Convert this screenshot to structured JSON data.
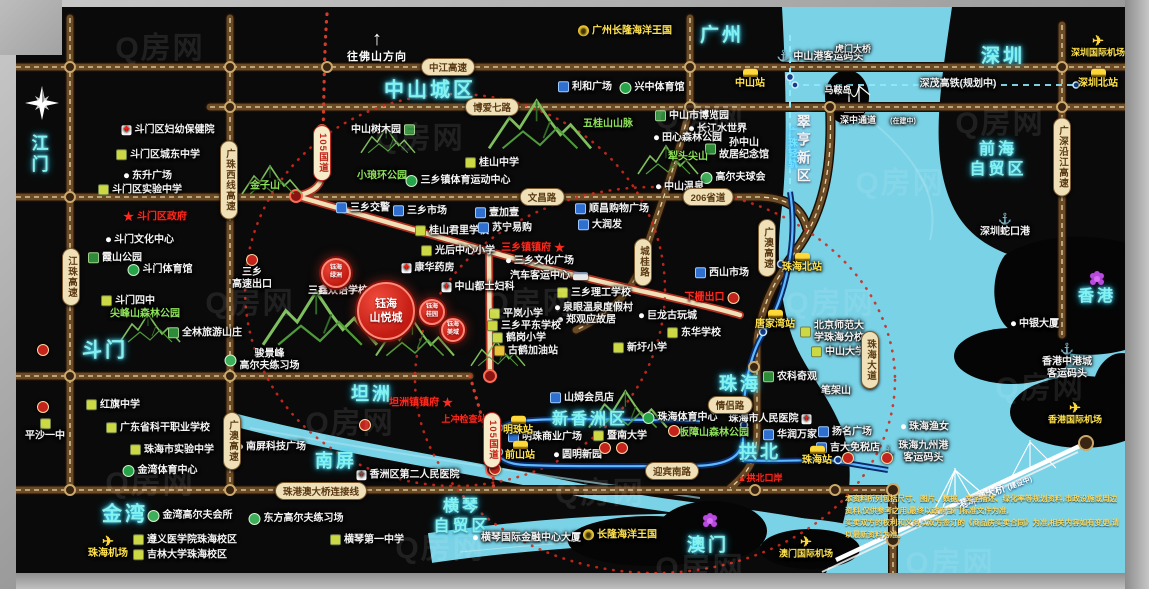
{
  "watermark": "Q房网",
  "direction": "往佛山方向",
  "compass": "N",
  "bridge": {
    "label": "港珠澳大桥",
    "status": "(建设中)"
  },
  "disclaimer": {
    "line1": "本资料所列包括尺寸、图片、数据、文字描述、绿化率等规划资料,市政设施或周边资料,仅供参考之用,最终以政府部门标准文件为准,",
    "line2": "买卖双方的权利和义务以双方签订的《商品房买卖合同》为准,相关内容如有变更,请以最新资料为准。"
  },
  "property": {
    "main": {
      "x": 386,
      "y": 311,
      "r": 27,
      "fs": 11,
      "label": "钰海\n山悦城"
    },
    "satellites": [
      {
        "x": 336,
        "y": 273,
        "r": 13,
        "fs": 6,
        "label": "钰海\n绿洲"
      },
      {
        "x": 432,
        "y": 312,
        "r": 11,
        "fs": 6,
        "label": "钰海\n桂园"
      },
      {
        "x": 453,
        "y": 330,
        "r": 10,
        "fs": 6,
        "label": "钰海\n美域"
      }
    ]
  },
  "regions": [
    {
      "x": 38,
      "y": 155,
      "l": "江门",
      "fs": 17,
      "v": 1
    },
    {
      "x": 105,
      "y": 351,
      "l": "斗门",
      "fs": 20
    },
    {
      "x": 125,
      "y": 515,
      "l": "金湾",
      "fs": 20
    },
    {
      "x": 430,
      "y": 91,
      "l": "中山城区",
      "fs": 20
    },
    {
      "x": 722,
      "y": 36,
      "l": "广州",
      "fs": 19
    },
    {
      "x": 1003,
      "y": 57,
      "l": "深圳",
      "fs": 19
    },
    {
      "x": 803,
      "y": 150,
      "l": "翠亨新区",
      "fs": 14,
      "v": 1,
      "w": 1
    },
    {
      "x": 998,
      "y": 160,
      "l": "前海\n自贸区",
      "fs": 16
    },
    {
      "x": 1097,
      "y": 297,
      "l": "香港",
      "fs": 16
    },
    {
      "x": 740,
      "y": 384,
      "l": "珠海",
      "fs": 18
    },
    {
      "x": 372,
      "y": 394,
      "l": "坦洲",
      "fs": 18
    },
    {
      "x": 336,
      "y": 461,
      "l": "南屏",
      "fs": 18
    },
    {
      "x": 590,
      "y": 420,
      "l": "新香洲区",
      "fs": 16
    },
    {
      "x": 760,
      "y": 452,
      "l": "拱北",
      "fs": 18
    },
    {
      "x": 462,
      "y": 517,
      "l": "横琴\n自贸区",
      "fs": 16
    },
    {
      "x": 708,
      "y": 545,
      "l": "澳门",
      "fs": 18
    }
  ],
  "badges": [
    {
      "x": 448,
      "y": 67,
      "l": "中江高速"
    },
    {
      "x": 492,
      "y": 107,
      "l": "博爱七路"
    },
    {
      "x": 542,
      "y": 197,
      "l": "文昌路"
    },
    {
      "x": 708,
      "y": 197,
      "l": "206省道"
    },
    {
      "x": 730,
      "y": 405,
      "l": "情侣路"
    },
    {
      "x": 672,
      "y": 471,
      "l": "迎宾南路"
    },
    {
      "x": 321,
      "y": 491,
      "l": "珠港澳大桥连接线"
    },
    {
      "x": 71,
      "y": 277,
      "l": "江珠高速",
      "v": 1
    },
    {
      "x": 229,
      "y": 180,
      "l": "广珠西线高速",
      "v": 1
    },
    {
      "x": 232,
      "y": 441,
      "l": "广澳高速",
      "v": 1
    },
    {
      "x": 643,
      "y": 262,
      "l": "城桂路",
      "v": 1
    },
    {
      "x": 767,
      "y": 248,
      "l": "广澳高速",
      "v": 1
    },
    {
      "x": 322,
      "y": 153,
      "l": "105国道",
      "v": 1,
      "cls": "red"
    },
    {
      "x": 492,
      "y": 440,
      "l": "105国道",
      "v": 1,
      "cls": "red"
    },
    {
      "x": 1062,
      "y": 157,
      "l": "广深沿江高速",
      "v": 1
    },
    {
      "x": 870,
      "y": 360,
      "l": "珠海大道",
      "v": 1
    },
    {
      "x": 791,
      "y": 148,
      "l": "广珠轻轨",
      "v": 1,
      "cls": "cyan"
    }
  ],
  "landmarks": [
    {
      "x": 168,
      "y": 130,
      "l": "斗门区妇幼保健院",
      "t": "hosp"
    },
    {
      "x": 158,
      "y": 155,
      "l": "斗门区城东中学",
      "t": "school"
    },
    {
      "x": 148,
      "y": 176,
      "l": "东升广场",
      "t": "dot"
    },
    {
      "x": 140,
      "y": 190,
      "l": "斗门区实验中学",
      "t": "school"
    },
    {
      "x": 155,
      "y": 217,
      "l": "斗门区政府",
      "t": "star",
      "c": "r"
    },
    {
      "x": 140,
      "y": 240,
      "l": "斗门文化中心",
      "t": "dot"
    },
    {
      "x": 115,
      "y": 258,
      "l": "霞山公园",
      "t": "park"
    },
    {
      "x": 160,
      "y": 270,
      "l": "斗门体育馆",
      "t": "sport"
    },
    {
      "x": 128,
      "y": 301,
      "l": "斗门四中",
      "t": "school"
    },
    {
      "x": 145,
      "y": 314,
      "l": "尖峰山森林公园",
      "c": "g"
    },
    {
      "x": 205,
      "y": 333,
      "l": "全林旅游山庄",
      "t": "park"
    },
    {
      "x": 265,
      "y": 186,
      "l": "金子山",
      "c": "g"
    },
    {
      "x": 252,
      "y": 272,
      "l": "三乡\n高速出口",
      "t": "toll",
      "col": 1
    },
    {
      "x": 262,
      "y": 360,
      "l": "骏景峰\n高尔夫练习场",
      "t": "golf"
    },
    {
      "x": 383,
      "y": 130,
      "l": "中山树木园",
      "t": "park",
      "ir": 1
    },
    {
      "x": 382,
      "y": 176,
      "l": "小琅环公园",
      "c": "g"
    },
    {
      "x": 458,
      "y": 181,
      "l": "三乡镇体育运动中心",
      "t": "sport"
    },
    {
      "x": 492,
      "y": 163,
      "l": "桂山中学",
      "t": "school"
    },
    {
      "x": 608,
      "y": 124,
      "l": "五桂山山脉",
      "c": "g"
    },
    {
      "x": 585,
      "y": 87,
      "l": "利和广场",
      "t": "shop"
    },
    {
      "x": 652,
      "y": 88,
      "l": "兴中体育馆",
      "t": "sport"
    },
    {
      "x": 692,
      "y": 116,
      "l": "中山市博览园",
      "t": "park"
    },
    {
      "x": 718,
      "y": 129,
      "l": "长江水世界",
      "t": "dot"
    },
    {
      "x": 688,
      "y": 138,
      "l": "田心森林公园",
      "t": "dot"
    },
    {
      "x": 737,
      "y": 149,
      "l": "孙中山\n故居纪念馆",
      "t": "park"
    },
    {
      "x": 688,
      "y": 157,
      "l": "犁头尖山",
      "c": "g"
    },
    {
      "x": 733,
      "y": 178,
      "l": "高尔夫球会",
      "t": "golf"
    },
    {
      "x": 680,
      "y": 187,
      "l": "中山温泉",
      "t": "dot"
    },
    {
      "x": 625,
      "y": 31,
      "l": "广州长隆海洋王国",
      "t": "logo",
      "c": "y"
    },
    {
      "x": 363,
      "y": 208,
      "l": "三乡交警",
      "t": "shop"
    },
    {
      "x": 420,
      "y": 211,
      "l": "三乡市场",
      "t": "shop"
    },
    {
      "x": 452,
      "y": 231,
      "l": "桂山君里学校",
      "t": "school"
    },
    {
      "x": 458,
      "y": 251,
      "l": "光后中心小学",
      "t": "school"
    },
    {
      "x": 428,
      "y": 268,
      "l": "康华药房",
      "t": "hosp"
    },
    {
      "x": 478,
      "y": 287,
      "l": "中山都士妇科",
      "t": "hosp"
    },
    {
      "x": 338,
      "y": 291,
      "l": "三鑫双语学校"
    },
    {
      "x": 533,
      "y": 248,
      "l": "三乡镇镇府",
      "t": "star",
      "ir": 1,
      "c": "r"
    },
    {
      "x": 540,
      "y": 261,
      "l": "三乡文化广场",
      "t": "dot"
    },
    {
      "x": 549,
      "y": 276,
      "l": "汽车客运中心",
      "t": "bus",
      "ir": 1
    },
    {
      "x": 594,
      "y": 293,
      "l": "三乡理工学校",
      "t": "school"
    },
    {
      "x": 594,
      "y": 308,
      "l": "泉眼温泉度假村",
      "t": "dot"
    },
    {
      "x": 587,
      "y": 320,
      "l": "郑观应故居",
      "t": "dot"
    },
    {
      "x": 516,
      "y": 314,
      "l": "平岚小学",
      "t": "school"
    },
    {
      "x": 524,
      "y": 326,
      "l": "三乡平东学校",
      "t": "school"
    },
    {
      "x": 519,
      "y": 338,
      "l": "鹤岗小学",
      "t": "school"
    },
    {
      "x": 526,
      "y": 351,
      "l": "古鹤加油站",
      "t": "gas"
    },
    {
      "x": 497,
      "y": 213,
      "l": "壹加壹",
      "t": "shop"
    },
    {
      "x": 505,
      "y": 228,
      "l": "苏宁易购",
      "t": "shop"
    },
    {
      "x": 600,
      "y": 225,
      "l": "大润发",
      "t": "shop"
    },
    {
      "x": 612,
      "y": 209,
      "l": "顺昌购物广场",
      "t": "shop"
    },
    {
      "x": 722,
      "y": 273,
      "l": "西山市场",
      "t": "shop"
    },
    {
      "x": 712,
      "y": 298,
      "l": "下栅出口",
      "t": "toll",
      "ir": 1,
      "c": "r"
    },
    {
      "x": 668,
      "y": 316,
      "l": "巨龙古玩城",
      "t": "dot"
    },
    {
      "x": 694,
      "y": 333,
      "l": "东华学校",
      "t": "school"
    },
    {
      "x": 640,
      "y": 348,
      "l": "新圩小学",
      "t": "school"
    },
    {
      "x": 832,
      "y": 332,
      "l": "北京师范大\n学珠海分校",
      "t": "school"
    },
    {
      "x": 838,
      "y": 352,
      "l": "中山大学",
      "t": "school"
    },
    {
      "x": 790,
      "y": 377,
      "l": "农科奇观",
      "t": "park"
    },
    {
      "x": 836,
      "y": 391,
      "l": "笔架山"
    },
    {
      "x": 1035,
      "y": 324,
      "l": "中银大厦",
      "t": "dot"
    },
    {
      "x": 582,
      "y": 398,
      "l": "山姆会员店",
      "t": "shop"
    },
    {
      "x": 680,
      "y": 418,
      "l": "珠海体育中心",
      "t": "sport"
    },
    {
      "x": 770,
      "y": 419,
      "l": "珠海市人民医院",
      "t": "hosp",
      "ir": 1
    },
    {
      "x": 790,
      "y": 435,
      "l": "华润万家",
      "t": "shop"
    },
    {
      "x": 845,
      "y": 432,
      "l": "扬名广场",
      "t": "shop"
    },
    {
      "x": 848,
      "y": 448,
      "l": "吉大免税店",
      "t": "shop"
    },
    {
      "x": 545,
      "y": 437,
      "l": "明珠商业广场",
      "t": "shop"
    },
    {
      "x": 620,
      "y": 436,
      "l": "暨南大学",
      "t": "school"
    },
    {
      "x": 578,
      "y": 455,
      "l": "圆明新园",
      "t": "dot"
    },
    {
      "x": 714,
      "y": 433,
      "l": "板障山森林公园",
      "c": "g"
    },
    {
      "x": 296,
      "y": 519,
      "l": "东方高尔夫练习场",
      "t": "golf"
    },
    {
      "x": 272,
      "y": 447,
      "l": "南屏科技广场",
      "t": "dot"
    },
    {
      "x": 113,
      "y": 405,
      "l": "红旗中学",
      "t": "school"
    },
    {
      "x": 158,
      "y": 428,
      "l": "广东省科干职业学校",
      "t": "school"
    },
    {
      "x": 172,
      "y": 450,
      "l": "珠海市实验中学",
      "t": "school"
    },
    {
      "x": 160,
      "y": 471,
      "l": "金湾体育中心",
      "t": "sport"
    },
    {
      "x": 45,
      "y": 430,
      "l": "平沙一中",
      "t": "school",
      "col": 1
    },
    {
      "x": 190,
      "y": 516,
      "l": "金湾高尔夫会所",
      "t": "golf"
    },
    {
      "x": 185,
      "y": 540,
      "l": "遵义医学院珠海校区",
      "t": "school"
    },
    {
      "x": 180,
      "y": 555,
      "l": "吉林大学珠海校区",
      "t": "school"
    },
    {
      "x": 367,
      "y": 540,
      "l": "横琴第一中学",
      "t": "school"
    },
    {
      "x": 527,
      "y": 538,
      "l": "横琴国际金融中心大厦",
      "t": "dot"
    },
    {
      "x": 408,
      "y": 475,
      "l": "香洲区第二人民医院",
      "t": "hosp"
    },
    {
      "x": 620,
      "y": 535,
      "l": "长隆海洋王国",
      "t": "logo",
      "c": "y"
    },
    {
      "x": 925,
      "y": 427,
      "l": "珠海渔女",
      "t": "dot"
    },
    {
      "x": 915,
      "y": 452,
      "l": "珠海九州港\n客运码头",
      "t": "anchor"
    },
    {
      "x": 820,
      "y": 57,
      "l": "中山港客运码头",
      "t": "anchor"
    },
    {
      "x": 1005,
      "y": 226,
      "l": "深圳蛇口港",
      "t": "anchor",
      "col": 1
    },
    {
      "x": 1067,
      "y": 362,
      "l": "香港中港城\n客运码头",
      "t": "anchor",
      "col": 1
    },
    {
      "x": 853,
      "y": 49,
      "l": "虎门大桥",
      "fs": 9
    },
    {
      "x": 838,
      "y": 90,
      "l": "马鞍岛",
      "fs": 9
    },
    {
      "x": 858,
      "y": 120,
      "l": "深中通道",
      "fs": 9
    },
    {
      "x": 903,
      "y": 122,
      "l": "(在建中)",
      "fs": 7
    },
    {
      "x": 958,
      "y": 84,
      "l": "深茂高铁(规划中)",
      "fs": 10
    },
    {
      "x": 421,
      "y": 403,
      "l": "坦洲镇镇府",
      "t": "star",
      "ir": 1,
      "c": "r"
    },
    {
      "x": 464,
      "y": 419,
      "l": "上冲检查站",
      "c": "r",
      "fs": 9
    },
    {
      "x": 760,
      "y": 478,
      "l": "▲拱北口岸",
      "c": "r",
      "fs": 9
    },
    {
      "x": 750,
      "y": 79,
      "l": "中山站",
      "t": "train",
      "col": 1,
      "c": "y"
    },
    {
      "x": 1098,
      "y": 79,
      "l": "深圳北站",
      "t": "train",
      "col": 1,
      "c": "y"
    },
    {
      "x": 802,
      "y": 263,
      "l": "珠海北站",
      "t": "train",
      "col": 1,
      "c": "y"
    },
    {
      "x": 775,
      "y": 320,
      "l": "唐家湾站",
      "t": "train",
      "col": 1,
      "c": "y"
    },
    {
      "x": 518,
      "y": 426,
      "l": "明珠站",
      "t": "train",
      "col": 1,
      "c": "y"
    },
    {
      "x": 520,
      "y": 451,
      "l": "前山站",
      "t": "train",
      "col": 1,
      "c": "y"
    },
    {
      "x": 817,
      "y": 456,
      "l": "珠海站",
      "t": "train",
      "col": 1,
      "c": "y"
    },
    {
      "x": 1098,
      "y": 46,
      "l": "深圳国际机场",
      "t": "plane",
      "col": 1,
      "c": "y",
      "fs": 9
    },
    {
      "x": 108,
      "y": 547,
      "l": "珠海机场",
      "t": "plane",
      "col": 1,
      "c": "y"
    },
    {
      "x": 806,
      "y": 547,
      "l": "澳门国际机场",
      "t": "plane",
      "col": 1,
      "c": "y",
      "fs": 9
    },
    {
      "x": 1075,
      "y": 413,
      "l": "香港国际机场",
      "t": "plane",
      "col": 1,
      "c": "y",
      "fs": 9
    },
    {
      "x": 710,
      "y": 521,
      "l": "",
      "t": "flower"
    },
    {
      "x": 1097,
      "y": 279,
      "l": "",
      "t": "flower"
    }
  ],
  "toll_dots": [
    [
      43,
      350
    ],
    [
      43,
      407
    ],
    [
      365,
      425
    ],
    [
      495,
      469
    ],
    [
      848,
      458
    ],
    [
      887,
      458
    ],
    [
      605,
      448
    ],
    [
      622,
      448
    ],
    [
      674,
      431
    ]
  ],
  "watermark_positions": [
    [
      160,
      45
    ],
    [
      420,
      135
    ],
    [
      700,
      115
    ],
    [
      1000,
      120
    ],
    [
      250,
      300
    ],
    [
      530,
      300
    ],
    [
      830,
      300
    ],
    [
      1040,
      385
    ],
    [
      150,
      480
    ],
    [
      440,
      545
    ],
    [
      700,
      565
    ],
    [
      950,
      560
    ],
    [
      350,
      420
    ],
    [
      600,
      490
    ],
    [
      900,
      180
    ]
  ]
}
